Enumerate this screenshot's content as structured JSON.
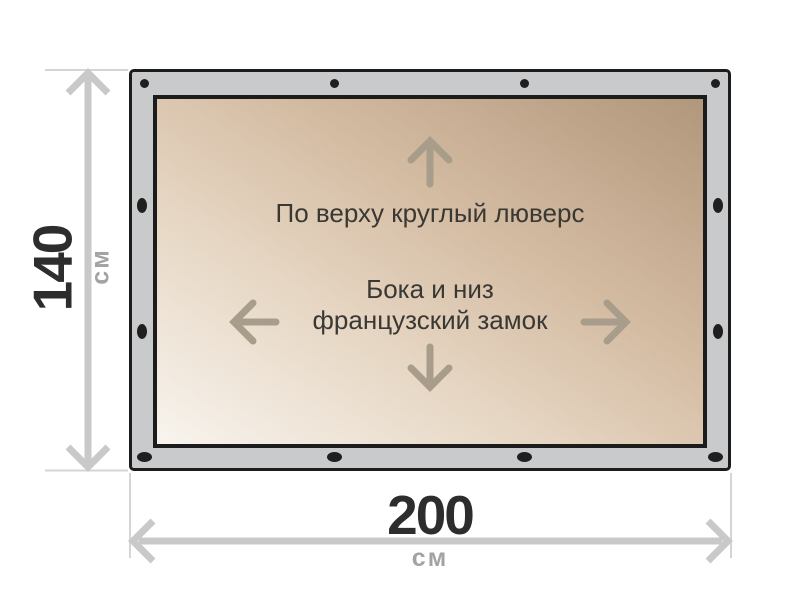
{
  "diagram": {
    "kind": "tarp-dimension-diagram",
    "height": {
      "value": "140",
      "unit": "см"
    },
    "width": {
      "value": "200",
      "unit": "см"
    },
    "notes": {
      "top_edge": "По верху круглый люверс",
      "sides_bottom_line1": "Бока и низ",
      "sides_bottom_line2": "французский замок"
    },
    "icons": {
      "top_edge_arrow": "arrow-up-icon",
      "left_edge_arrow": "arrow-left-icon",
      "right_edge_arrow": "arrow-right-icon",
      "bottom_edge_arrow": "arrow-down-icon"
    },
    "colors": {
      "frame_fill": "#c9cacb",
      "frame_border": "#1c1c1c",
      "fabric_gradient_light": "#f8f4ee",
      "fabric_gradient_dark": "#b1977b",
      "grommet": "#1f1f1f",
      "dimension_line": "#c9c9c9",
      "extension_line": "#d5d5d5",
      "inner_arrow": "#a89c8b",
      "value_text": "#2d2d2d",
      "unit_text": "#a3a3a3",
      "note_text": "#3a3833"
    }
  }
}
